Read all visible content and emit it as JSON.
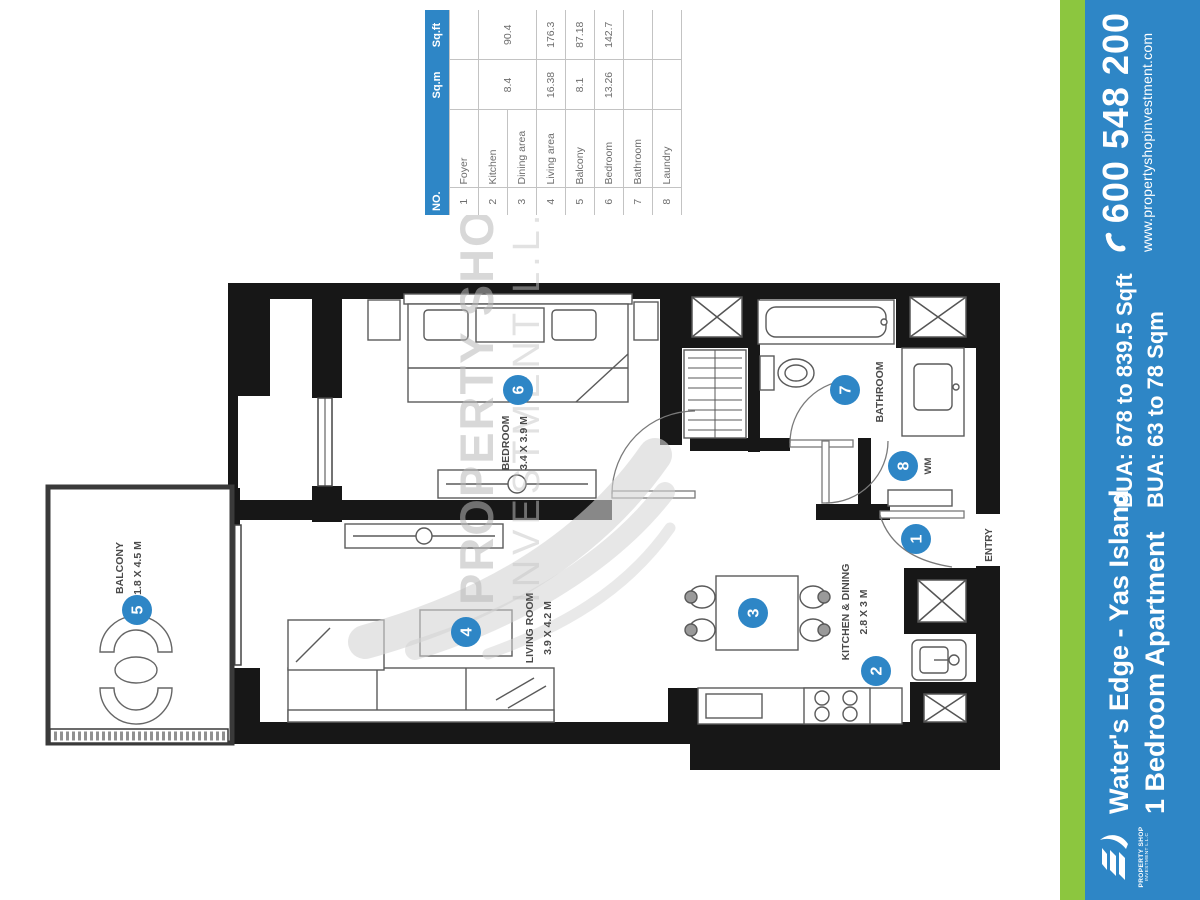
{
  "colors": {
    "accent_blue": "#2e86c6",
    "accent_green": "#8cc63f",
    "wall": "#171717"
  },
  "area_table": {
    "headers": {
      "no": "NO.",
      "room": "",
      "sqm": "Sq.m",
      "sqft": "Sq.ft"
    },
    "rows": [
      {
        "no": "1",
        "room": "Foyer",
        "sqm": "",
        "sqft": ""
      },
      {
        "no": "2",
        "room": "Kitchen",
        "sqm": "8.4",
        "sqft": "90.4"
      },
      {
        "no": "3",
        "room": "Dining area",
        "sqm": "",
        "sqft": ""
      },
      {
        "no": "4",
        "room": "Living area",
        "sqm": "16.38",
        "sqft": "176.3"
      },
      {
        "no": "5",
        "room": "Balcony",
        "sqm": "8.1",
        "sqft": "87.18"
      },
      {
        "no": "6",
        "room": "Bedroom",
        "sqm": "13.26",
        "sqft": "142.7"
      },
      {
        "no": "7",
        "room": "Bathroom",
        "sqm": "",
        "sqft": ""
      },
      {
        "no": "8",
        "room": "Laundry",
        "sqm": "",
        "sqft": ""
      }
    ]
  },
  "plan": {
    "watermark": {
      "line1": "PROPERTY SHOP",
      "line2": "INVESTMENT L.L.C"
    },
    "rooms": {
      "bedroom": {
        "label": "BEDROOM",
        "dims": "3.4 X 3.9 M",
        "marker": "6"
      },
      "bathroom": {
        "label": "BATHROOM",
        "marker": "7"
      },
      "laundry": {
        "label": "WM",
        "marker": "8"
      },
      "entry": {
        "label": "ENTRY",
        "marker": "1"
      },
      "kitchen_dining": {
        "label": "KITCHEN & DINING",
        "dims": "2.8 X 3 M",
        "marker_kitchen": "2",
        "marker_dining": "3"
      },
      "living": {
        "label": "LIVING ROOM",
        "dims": "3.9 X 4.2 M",
        "marker": "4"
      },
      "balcony": {
        "label": "BALCONY",
        "dims": "1.8 X 4.5 M",
        "marker": "5"
      }
    }
  },
  "sidebar": {
    "phone": "600 548 200",
    "website": "www.propertyshopinvestment.com",
    "bua_line1": "BUA: 678 to 839.5 Sqft",
    "bua_line2": "BUA: 63 to 78 Sqm",
    "project": "Water's Edge - Yas Island",
    "unit": "1 Bedroom Apartment",
    "logo_top": "PROPERTY SHOP",
    "logo_bottom": "INVESTMENT L.L.C"
  }
}
